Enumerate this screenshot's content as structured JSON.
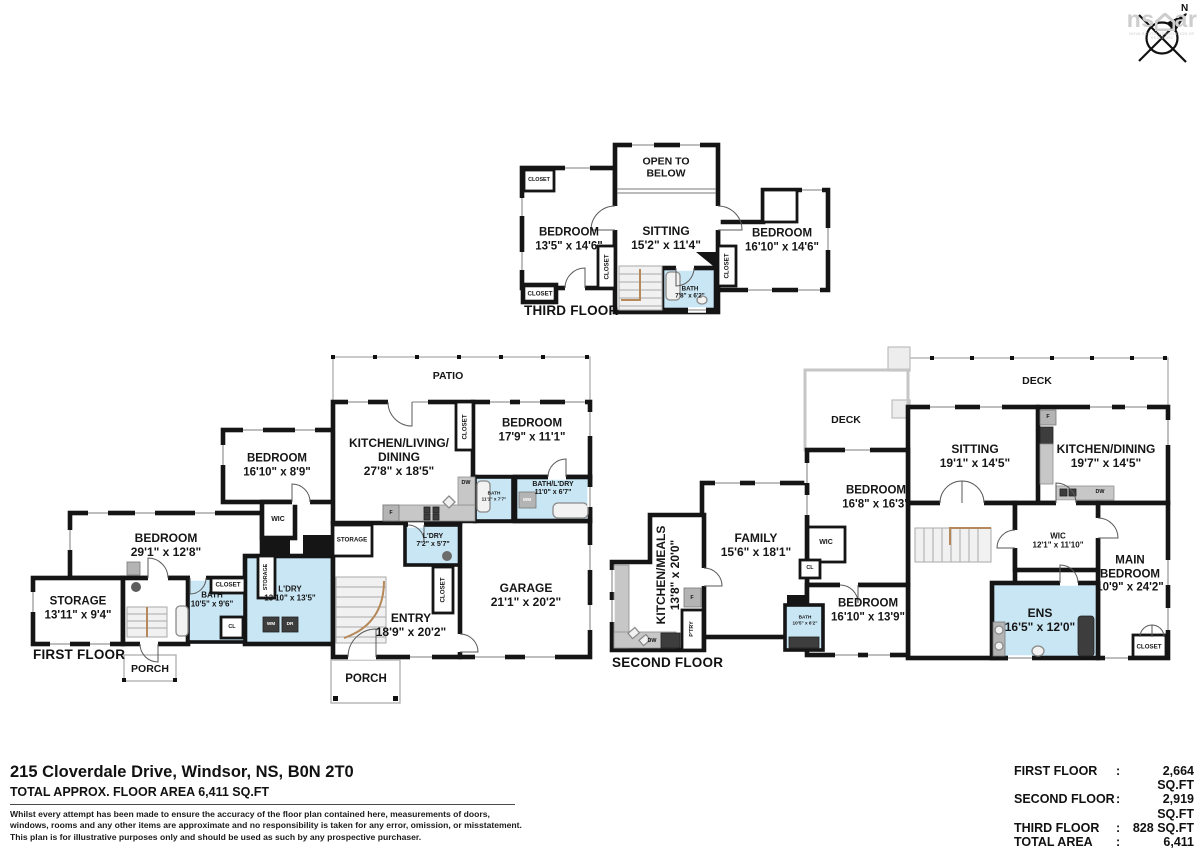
{
  "logo": {
    "brand_left": "ns",
    "brand_right": "ar",
    "tagline": "NOVA SCOTIA ASSOCIATION OF REALTORS",
    "north": "N"
  },
  "floors": {
    "third": {
      "title": "THIRD FLOOR",
      "open1": "OPEN TO",
      "open2": "BELOW",
      "sitting_name": "SITTING",
      "sitting_dims": "15'2\" x 11'4\"",
      "bed_left_name": "BEDROOM",
      "bed_left_dims": "13'5\" x 14'6\"",
      "bed_right_name": "BEDROOM",
      "bed_right_dims": "16'10\" x 14'6\"",
      "bath_name": "BATH",
      "bath_dims": "7'8\" x 6'2\"",
      "closet": "CLOSET"
    },
    "first": {
      "title": "FIRST FLOOR",
      "patio": "PATIO",
      "porch": "PORCH",
      "kld1": "KITCHEN/LIVING/",
      "kld2": "DINING",
      "kld_dims": "27'8\" x 18'5\"",
      "bedroom1_name": "BEDROOM",
      "bedroom1_dims": "17'9\" x 11'1\"",
      "bath_small_name": "BATH",
      "bath_small_dims": "11'1\" x 7'7\"",
      "bath_ldry_name": "BATH/L'DRY",
      "bath_ldry_dims": "11'0\" x 6'7\"",
      "ldry_small_name": "L'DRY",
      "ldry_small_dims": "7'2\" x 5'7\"",
      "entry_name": "ENTRY",
      "entry_dims": "18'9\" x 20'2\"",
      "garage_name": "GARAGE",
      "garage_dims": "21'1\" x 20'2\"",
      "bedroom2_name": "BEDROOM",
      "bedroom2_dims": "16'10\" x 8'9\"",
      "bedroom3_name": "BEDROOM",
      "bedroom3_dims": "29'1\" x 12'8\"",
      "storage_name": "STORAGE",
      "storage_dims": "13'11\" x 9'4\"",
      "bath2_name": "BATH",
      "bath2_dims": "10'5\" x 9'6\"",
      "ldry_big_name": "L'DRY",
      "ldry_big_dims": "13'10\" x 13'5\"",
      "wic": "WIC",
      "storage_sm": "STORAGE",
      "closet": "CLOSET",
      "cl": "CL",
      "wm": "WM",
      "dr": "DR",
      "dw": "DW",
      "f": "F"
    },
    "second": {
      "title": "SECOND FLOOR",
      "deck": "DECK",
      "sitting_name": "SITTING",
      "sitting_dims": "19'1\" x 14'5\"",
      "kd_name": "KITCHEN/DINING",
      "kd_dims": "19'7\" x 14'5\"",
      "bedroom_a_name": "BEDROOM",
      "bedroom_a_dims": "16'8\" x 16'3\"",
      "family_name": "FAMILY",
      "family_dims": "15'6\" x 18'1\"",
      "km_name": "KITCHEN/MEALS",
      "km_dims": "13'8\" x 20'0\"",
      "wic_large_name": "WIC",
      "wic_large_dims": "12'1\" x 11'10\"",
      "main1": "MAIN",
      "main2": "BEDROOM",
      "main_dims": "10'9\" x 24'2\"",
      "bedroom_b_name": "BEDROOM",
      "bedroom_b_dims": "16'10\" x 13'9\"",
      "bath_name": "BATH",
      "bath_dims": "10'5\" x 6'2\"",
      "ens_name": "ENS",
      "ens_dims": "16'5\" x 12'0\"",
      "wic": "WIC",
      "cl": "CL",
      "closet": "CLOSET",
      "ptry": "P'TRY",
      "dw": "DW",
      "f": "F"
    }
  },
  "footer": {
    "address": "215 Cloverdale Drive, Windsor, NS, B0N 2T0",
    "total_line": "TOTAL APPROX. FLOOR AREA 6,411 SQ.FT",
    "disclaimer_1": "Whilst every attempt has been made to ensure the accuracy of the floor plan contained here, measurements of doors,",
    "disclaimer_2": "windows, rooms and any other items are approximate and no responsibility is taken for any error, omission, or misstatement.",
    "disclaimer_3": "This plan is for illustrative purposes only and should be used as such by any prospective purchaser.",
    "areas": {
      "colon": ":",
      "rows": [
        {
          "label": "FIRST FLOOR",
          "value": "2,664 SQ.FT"
        },
        {
          "label": "SECOND FLOOR",
          "value": "2,919 SQ.FT"
        },
        {
          "label": "THIRD FLOOR",
          "value": "828 SQ.FT"
        },
        {
          "label": "TOTAL AREA",
          "value": "6,411 SQ.FT"
        },
        {
          "label": "GARAGE",
          "value": "489 SQ.FT"
        }
      ]
    }
  }
}
